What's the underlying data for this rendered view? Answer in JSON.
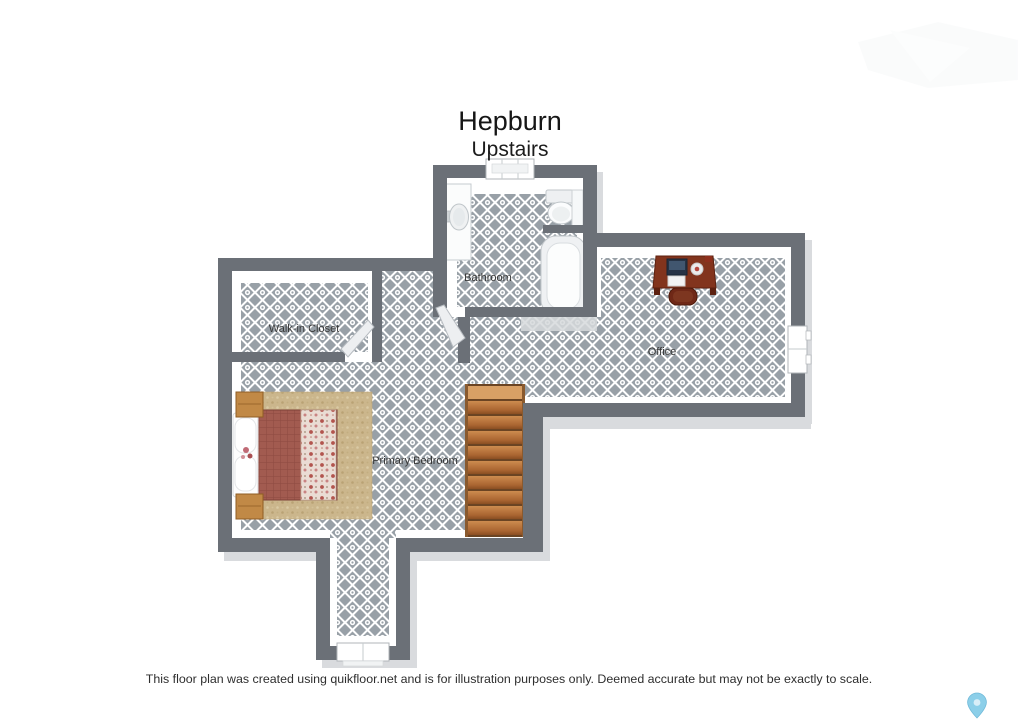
{
  "title": {
    "main": "Hepburn",
    "sub": "Upstairs"
  },
  "rooms": {
    "bathroom": {
      "label": "Bathroom"
    },
    "walk_in_closet": {
      "label": "Walk-in Closet"
    },
    "office": {
      "label": "Office"
    },
    "primary_bedroom": {
      "label": "Primary Bedroom"
    }
  },
  "footer": {
    "disclaimer": "This floor plan was created using quikfloor.net and is for illustration purposes only. Deemed accurate but may not be exactly to scale."
  },
  "icons": {
    "location_pin": "location-pin-icon"
  },
  "furniture": {
    "bathroom": [
      "vanity-sink",
      "toilet",
      "storage-cabinet",
      "bathtub"
    ],
    "office": [
      "desk",
      "desk-chair",
      "laptop",
      "papers",
      "plate"
    ],
    "primary_bedroom": [
      "double-bed",
      "nightstand-top",
      "nightstand-bottom",
      "area-rug"
    ],
    "hall": [
      "staircase"
    ]
  },
  "doors": [
    "bathroom-door",
    "closet-door"
  ],
  "windows": [
    "bathroom-top-window",
    "office-right-window",
    "corridor-bottom-window"
  ],
  "colors": {
    "wall": "#6b7077",
    "floor_tile": "#98a0a7",
    "shadow": "#d9dbde",
    "stair_wood": "#b5763a",
    "bed_quilt": "#a25b50",
    "rug": "#cbb68c",
    "desk_wood": "#82341d",
    "pin_blue": "#8ccfe9"
  }
}
